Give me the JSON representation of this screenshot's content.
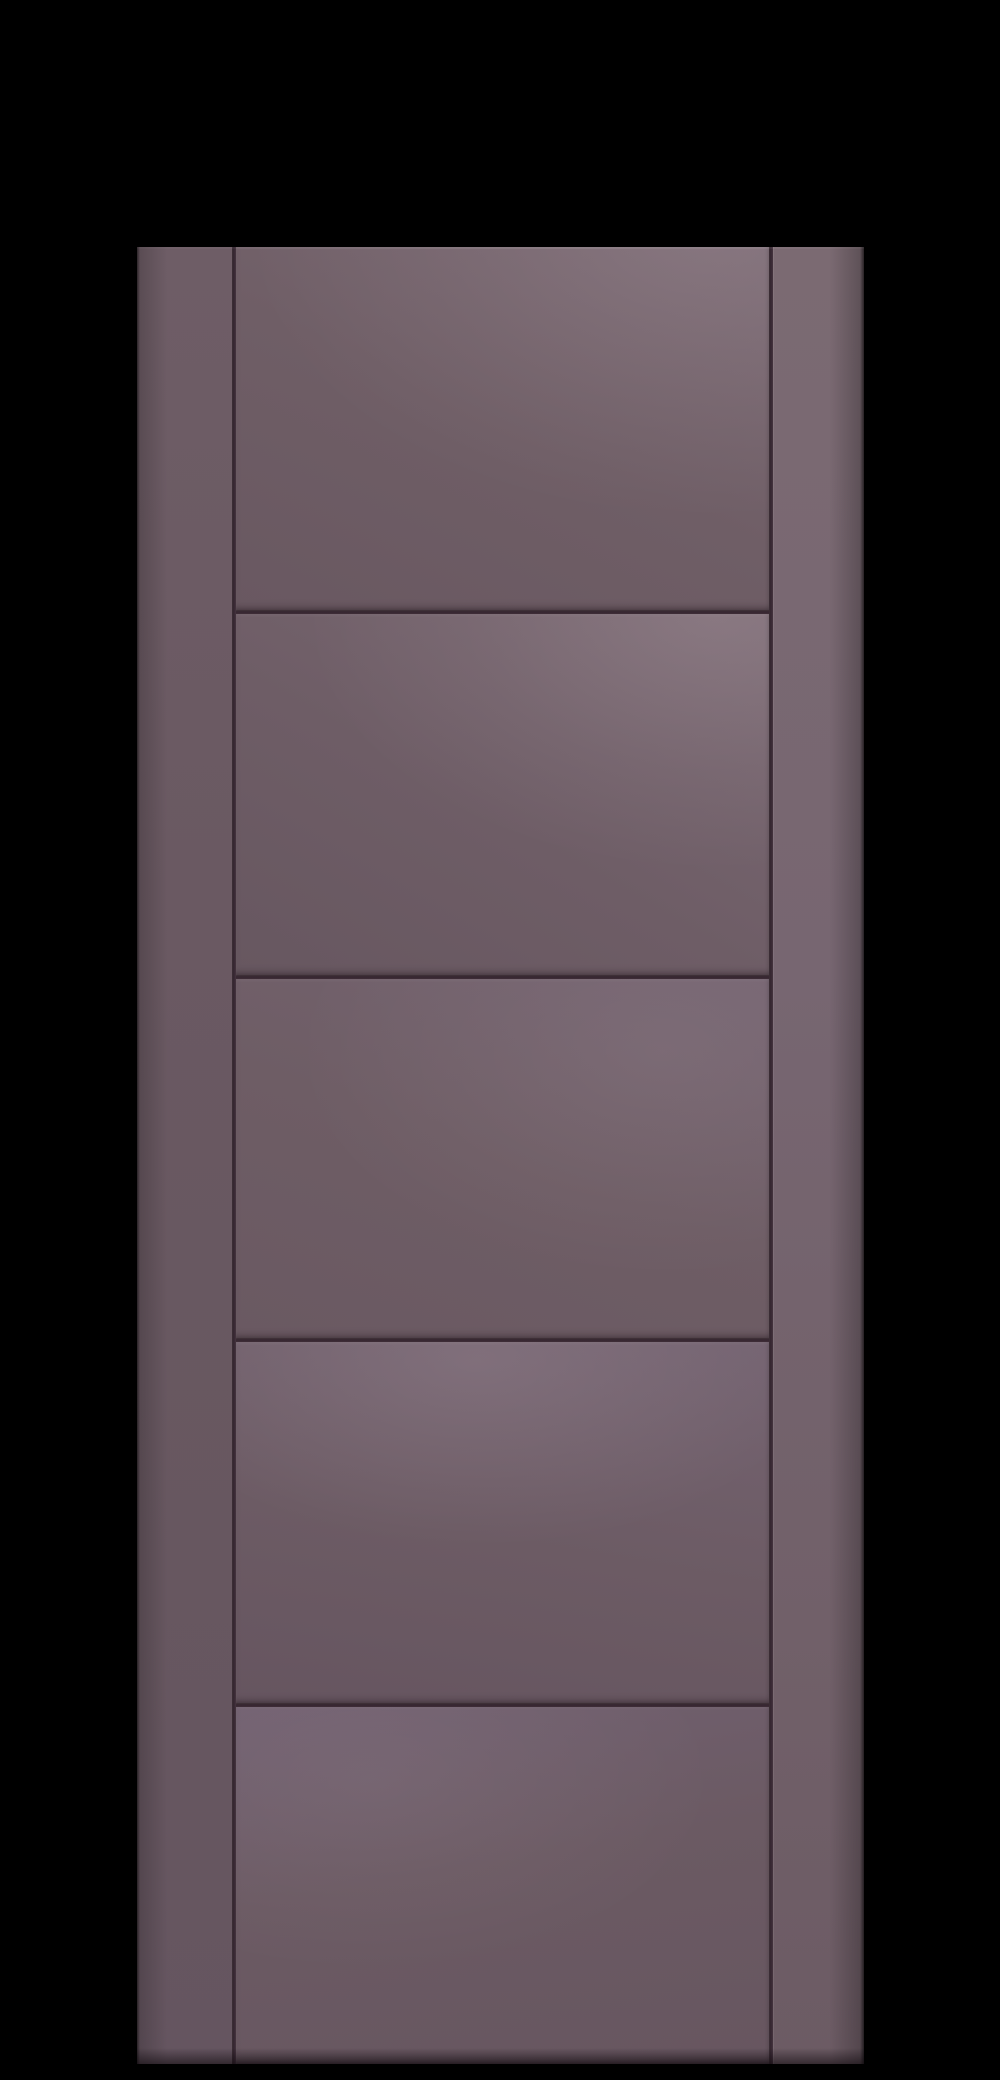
{
  "scene": {
    "type": "product-photo",
    "subject": "five-panel ladder-style interior door, mauve finish, on black backdrop",
    "text_content": "none"
  },
  "theme": {
    "backdrop": "#000000",
    "door-base": "#6e5d64",
    "door-light": "#7e6d74",
    "door-dark": "#655560",
    "groove": "#352530",
    "edge-shadow": "#46353d"
  },
  "door": {
    "panel_count": 5,
    "horizontal_groove_count": 4,
    "vertical_groove_count": 2,
    "orientation": "vertical"
  }
}
